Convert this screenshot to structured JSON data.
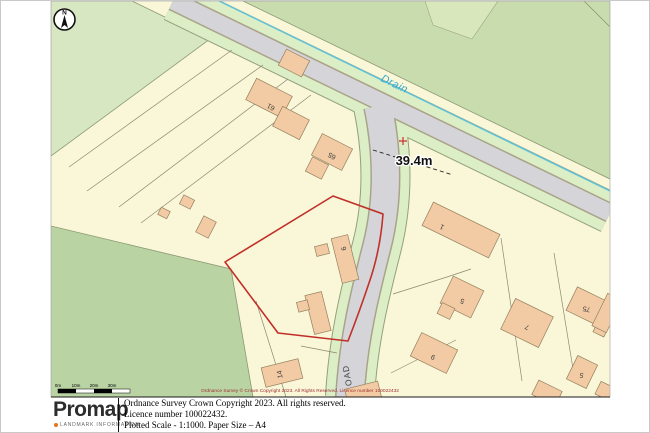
{
  "compass": {
    "north": "N"
  },
  "map": {
    "colors": {
      "field_light": "#D7E7C2",
      "field": "#C8DCAE",
      "field_dark": "#B9D3A3",
      "parcel": "#FAF6D8",
      "building": "#F2CBA4",
      "road": "#D5D4D8",
      "verge": "#DCEEC6",
      "drain": "#5FC3DD",
      "boundary_red": "#C03028"
    },
    "drain_label": "Drain",
    "road_label": "OAD",
    "measurement": "39.4m",
    "copyright": "Ordnance Survey © Crown Copyright 2023. All Rights Reserved. Licence number 100022432",
    "scalebar": [
      "0m",
      "10m",
      "20m",
      "30m"
    ],
    "buildings": [
      "61",
      "65",
      "6",
      "14",
      "1",
      "5",
      "7",
      "75",
      "9",
      "5"
    ]
  },
  "footer": {
    "logo": "Promap",
    "logo_sub": "LANDMARK INFORMATION",
    "lines": [
      "Ordnance Survey Crown Copyright 2023. All rights reserved.",
      "Licence number 100022432.",
      "Plotted Scale - 1:1000. Paper Size – A4"
    ]
  }
}
